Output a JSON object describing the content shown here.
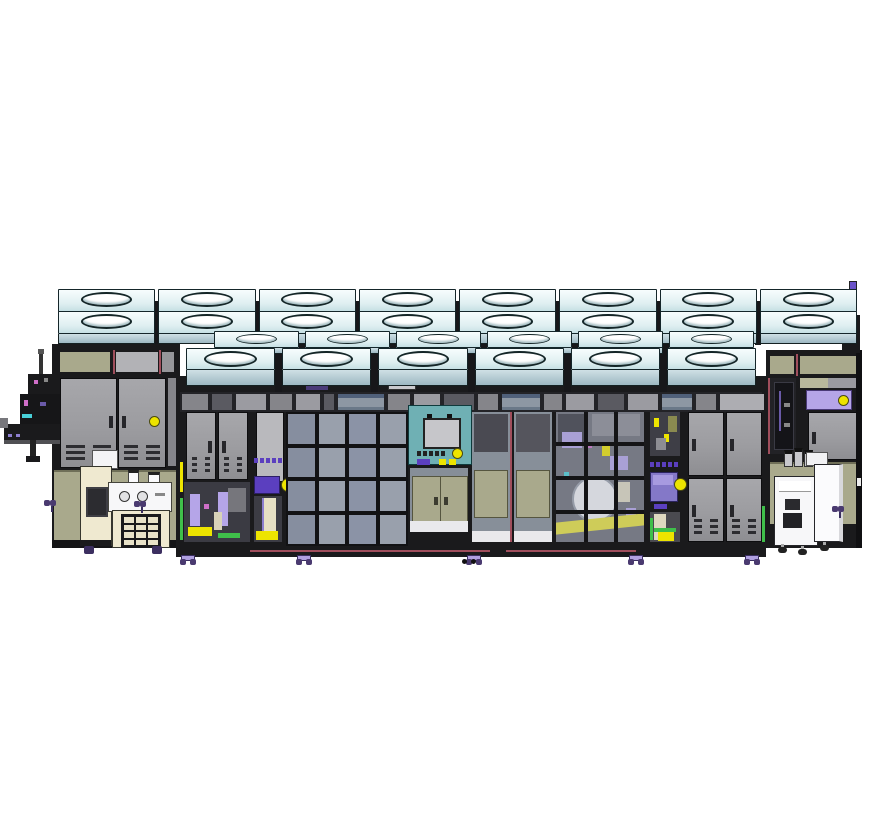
{
  "equipment": {
    "ffu_back_row_units": 8,
    "ffu_middle_row_units": 6,
    "ffu_front_row_units": 6,
    "left_bay": {
      "cabinet_doors": 2,
      "status_lights": 1
    },
    "main_bay": {
      "left_cabinet_doors": 2,
      "window_grid_left": {
        "cols": 4,
        "rows": 4,
        "panes": 16
      },
      "window_grid_right": {
        "cols": 3,
        "rows": 4,
        "panes": 12
      },
      "small_button_count": 5,
      "right_cabinet_doors": 4,
      "floor_casters": 5
    },
    "right_bay": {
      "cabinet_doors": 1,
      "status_lights": 2
    },
    "left_cart": {
      "keypad_keys": 12
    },
    "right_cart": {
      "casters": 3
    }
  },
  "palette": {
    "background": "#ffffff",
    "frame": "#1a1a1c",
    "ffu_mid": "#dfeff1",
    "ffu_face": "#cfe0e5",
    "ffu_face_dark": "#9db8c2",
    "oval_fill": "#ffffff",
    "door_gray": "#9c9ca0",
    "vent": "#2c2c30",
    "khaki": "#a9a98c",
    "glass_blue": "#8b93a6",
    "glass_blue_light": "#99a0ac",
    "teal": "#6fb0b4",
    "lavender": "#b5a5e8",
    "purple": "#5b3fbf",
    "purple_screen": "#8478c8",
    "yellow": "#ede400",
    "green": "#3fbf4a",
    "maroon": "#a04e5c",
    "cream": "#efe9d0",
    "white_unit": "#f7f7f9",
    "caster_dark": "#4a3a70"
  }
}
